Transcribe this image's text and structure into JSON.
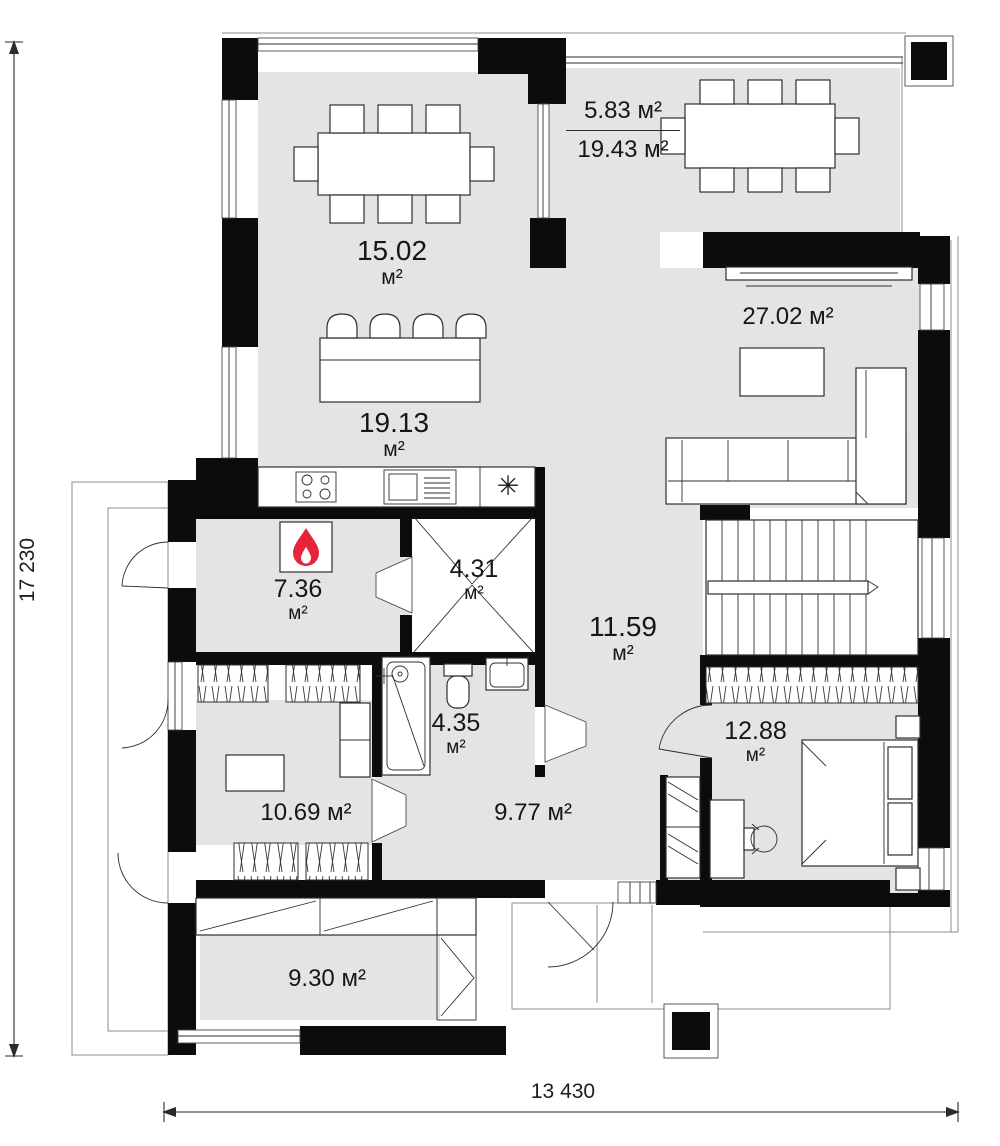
{
  "rooms": {
    "dining": {
      "value": "15.02",
      "unit": "м²"
    },
    "terrace": {
      "top": "5.83 м²",
      "bottom": "19.43 м²"
    },
    "living": {
      "label": "27.02 м²"
    },
    "kitchen": {
      "value": "19.13",
      "unit": "м²"
    },
    "boiler": {
      "value": "7.36",
      "unit": "м²"
    },
    "wardrobe": {
      "value": "4.31",
      "unit": "м²"
    },
    "hall_center": {
      "value": "11.59",
      "unit": "м²"
    },
    "bathroom": {
      "value": "4.35",
      "unit": "м²"
    },
    "bedroom": {
      "value": "12.88",
      "unit": "м²"
    },
    "office": {
      "label": "10.69 м²"
    },
    "hallway": {
      "label": "9.77 м²"
    },
    "storage": {
      "label": "9.30 м²"
    }
  },
  "dimensions": {
    "vertical": "17 230",
    "horizontal": "13 430"
  },
  "symbols": {
    "kitchen_asterisk": "✳"
  },
  "colors": {
    "wall": "#0c0c0c",
    "floor": "#e4e4e4",
    "line": "#2e2e2e",
    "thin": "#8c8c8c",
    "flame": "#e8243c"
  }
}
